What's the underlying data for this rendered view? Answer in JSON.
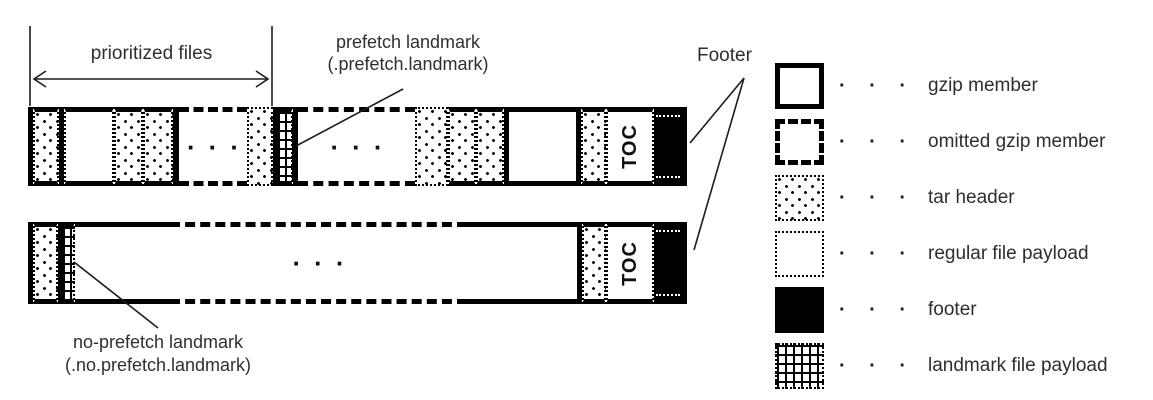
{
  "labels": {
    "prioritized_files": "prioritized files",
    "prefetch_landmark_line1": "prefetch landmark",
    "prefetch_landmark_line2": "(.prefetch.landmark)",
    "footer": "Footer",
    "no_prefetch_landmark_line1": "no-prefetch landmark",
    "no_prefetch_landmark_line2": "(.no.prefetch.landmark)"
  },
  "bars": {
    "top": {
      "name": "top-archive-bar",
      "segments": [
        {
          "kind": "border",
          "w": 5
        },
        {
          "kind": "tar-header",
          "edge": "solid",
          "w": 26
        },
        {
          "kind": "border",
          "w": 5
        },
        {
          "kind": "payload",
          "edge": "solid",
          "w": 50
        },
        {
          "kind": "tar-header",
          "edge": "solid",
          "w": 29
        },
        {
          "kind": "tar-header",
          "edge": "solid",
          "w": 30
        },
        {
          "kind": "border",
          "w": 6
        },
        {
          "kind": "omitted",
          "edge": "dash",
          "w": 68,
          "text": "···"
        },
        {
          "kind": "tar-header",
          "edge": "dot",
          "w": 26
        },
        {
          "kind": "border",
          "w": 5
        },
        {
          "kind": "landmark",
          "edge": "solid",
          "w": 15
        },
        {
          "kind": "border",
          "w": 5
        },
        {
          "kind": "omitted",
          "edge": "dash",
          "w": 117,
          "text": "···"
        },
        {
          "kind": "tar-header",
          "edge": "dot",
          "w": 33
        },
        {
          "kind": "tar-header",
          "edge": "solid",
          "w": 28
        },
        {
          "kind": "tar-header",
          "edge": "solid",
          "w": 28
        },
        {
          "kind": "border",
          "w": 5
        },
        {
          "kind": "member",
          "edge": "solid",
          "w": 67
        },
        {
          "kind": "border",
          "w": 5
        },
        {
          "kind": "tar-header",
          "edge": "solid",
          "w": 25
        },
        {
          "kind": "toc",
          "edge": "solid",
          "w": 48,
          "text": "TOC"
        },
        {
          "kind": "footer",
          "edge": "solid",
          "w": 28
        },
        {
          "kind": "border",
          "w": 5
        }
      ]
    },
    "bottom": {
      "name": "bottom-archive-bar",
      "segments": [
        {
          "kind": "border",
          "w": 5
        },
        {
          "kind": "tar-header",
          "edge": "solid",
          "w": 25
        },
        {
          "kind": "border",
          "w": 5
        },
        {
          "kind": "landmark",
          "edge": "solid",
          "w": 12
        },
        {
          "kind": "member",
          "edge": "solid",
          "w": 95
        },
        {
          "kind": "omitted",
          "edge": "dash",
          "w": 297,
          "text": "···"
        },
        {
          "kind": "member",
          "edge": "solid",
          "w": 110
        },
        {
          "kind": "border",
          "w": 5
        },
        {
          "kind": "tar-header",
          "edge": "solid",
          "w": 24
        },
        {
          "kind": "toc",
          "edge": "solid",
          "w": 48,
          "text": "TOC"
        },
        {
          "kind": "footer",
          "edge": "solid",
          "w": 28
        },
        {
          "kind": "border",
          "w": 5
        }
      ]
    }
  },
  "legend": {
    "separator": "· · ·",
    "items": [
      {
        "style": "gzip-member",
        "label": "gzip member"
      },
      {
        "style": "omitted-gzip-member",
        "label": "omitted gzip member"
      },
      {
        "style": "tar-header",
        "label": "tar header"
      },
      {
        "style": "regular-file-payload",
        "label": "regular file payload"
      },
      {
        "style": "footer",
        "label": "footer"
      },
      {
        "style": "landmark-file-payload",
        "label": "landmark file payload"
      }
    ]
  }
}
